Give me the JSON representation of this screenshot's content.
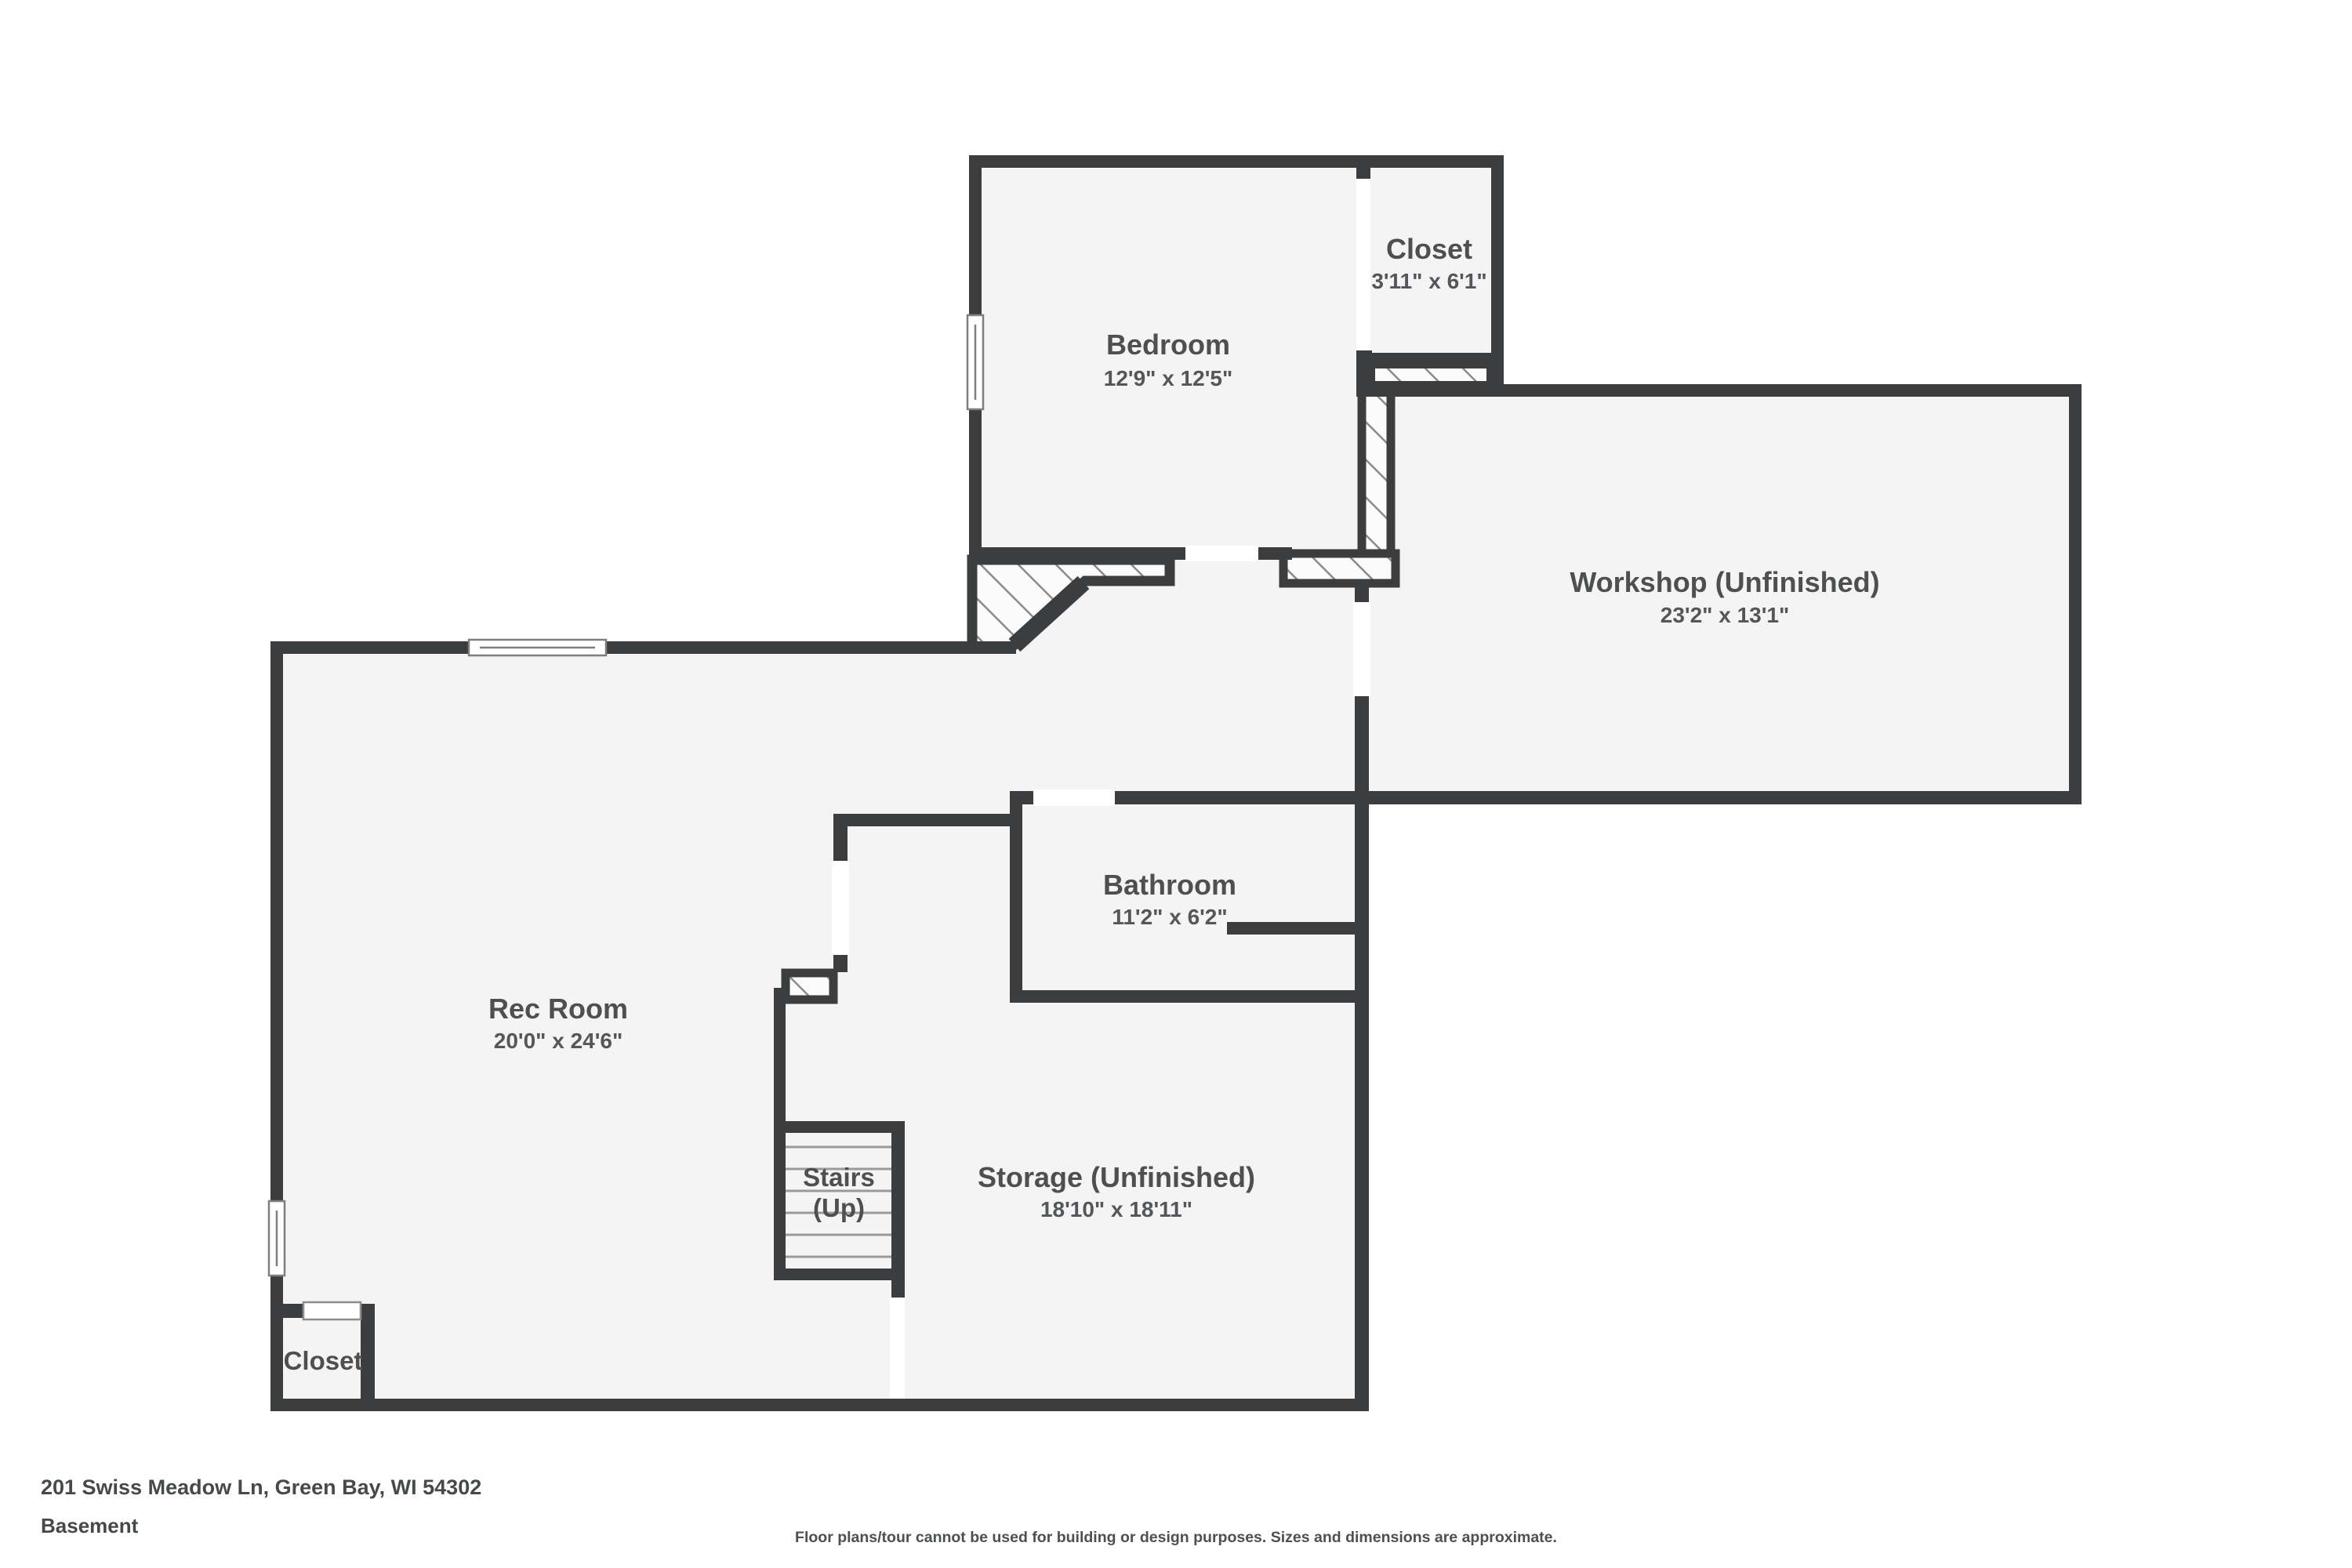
{
  "floorplan": {
    "rooms": {
      "bedroom": {
        "name": "Bedroom",
        "dims": "12'9\" x 12'5\""
      },
      "closet_top": {
        "name": "Closet",
        "dims": "3'11\" x 6'1\""
      },
      "workshop": {
        "name": "Workshop (Unfinished)",
        "dims": "23'2\" x 13'1\""
      },
      "rec_room": {
        "name": "Rec Room",
        "dims": "20'0\" x 24'6\""
      },
      "bathroom": {
        "name": "Bathroom",
        "dims": "11'2\" x 6'2\""
      },
      "stairs": {
        "name": "Stairs",
        "dims": "(Up)"
      },
      "storage": {
        "name": "Storage (Unfinished)",
        "dims": "18'10\" x 18'11\""
      },
      "closet_bottom": {
        "name": "Closet",
        "dims": ""
      }
    },
    "footer": {
      "address": "201 Swiss Meadow Ln, Green Bay, WI 54302",
      "level": "Basement",
      "disclaimer": "Floor plans/tour cannot be used for building or design purposes. Sizes and dimensions are approximate."
    },
    "colors": {
      "wall": "#3b3d3e",
      "floor": "#f4f4f4",
      "hatch_line": "#8a8a8a",
      "text": "#4d4f50",
      "text2": "#54575a"
    }
  }
}
